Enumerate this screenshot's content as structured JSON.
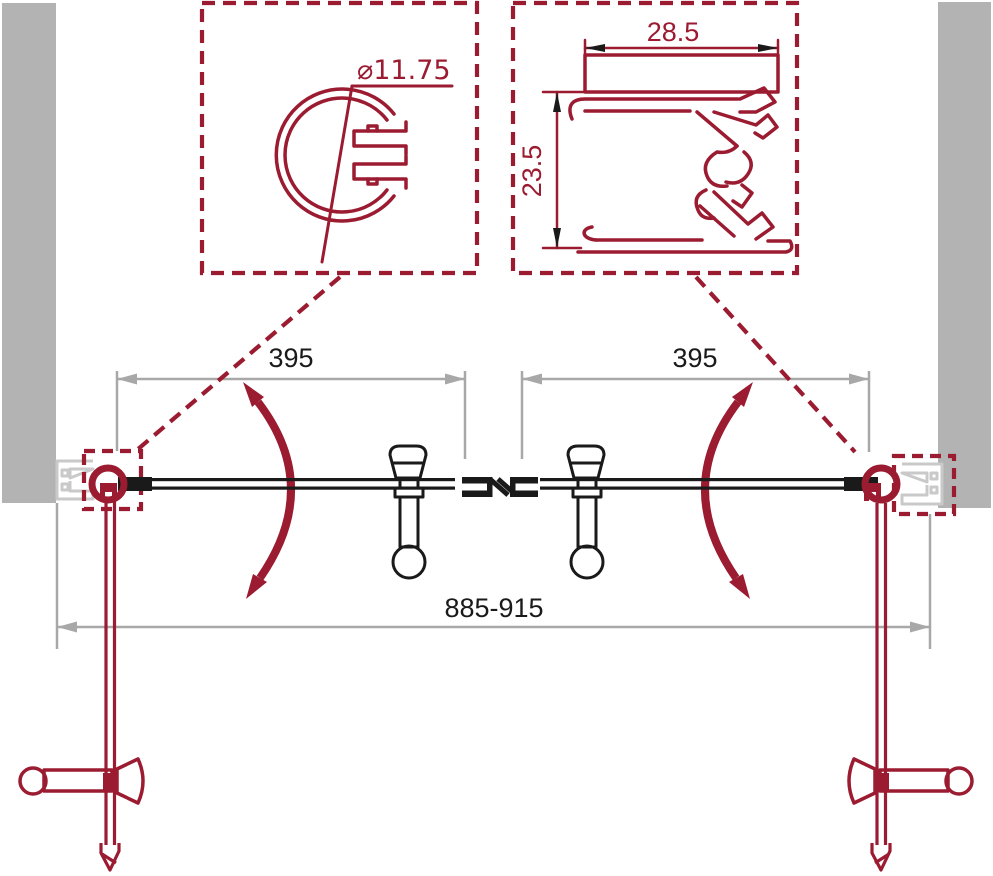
{
  "drawing": {
    "kind": "shower-door-technical-plan",
    "callout_left": {
      "name": "pivot-tube-profile-section",
      "diameter_label": "⌀11.75"
    },
    "callout_right": {
      "name": "wall-profile-section",
      "width_label": "28.5",
      "height_label": "23.5"
    },
    "plan_dimensions": {
      "left_door_width": "395",
      "right_door_width": "395",
      "overall_width": "885-915"
    },
    "colors": {
      "accent_red": "#9b1b31",
      "wall_gray": "#b3b3b3",
      "profile_light_gray": "#c9c9c9",
      "dimension_gray": "#a8a8a8",
      "ink_black": "#1a1a1a",
      "background": "#ffffff"
    }
  }
}
